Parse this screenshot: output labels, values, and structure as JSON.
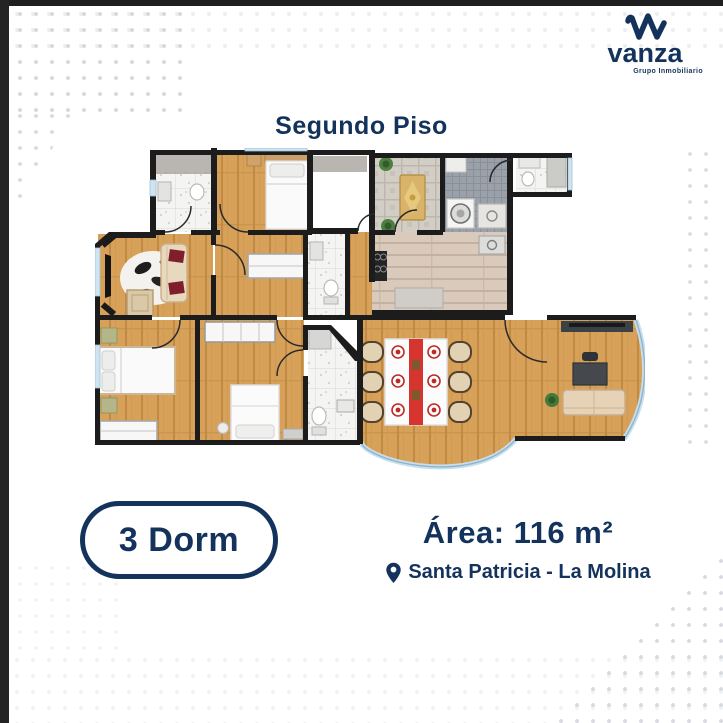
{
  "brand": {
    "name": "vanza",
    "tagline": "Grupo Inmobiliario"
  },
  "title": "Segundo Piso",
  "badge": {
    "label": "3 Dorm"
  },
  "details": {
    "area": "Área: 116 m²",
    "location": "Santa Patricia - La Molina"
  },
  "colors": {
    "navy": "#14335C",
    "dot_gray": "#D3D6DB",
    "wall_black": "#1C1C1C",
    "wood_floor": "#D7A159",
    "kitchen_floor": "#D9CABC",
    "terrace_stone": "#D2CDC5",
    "laundry_tile": "#9AA1A9",
    "bath_tile": "#F4F4F2",
    "glass_blue": "#BFDCEC",
    "runner_red": "#D6342E",
    "sofa_beige": "#E6D2B6"
  },
  "floor_plan": {
    "floor": "2",
    "bedrooms": 3,
    "rooms_depicted": [
      "bedroom-1",
      "bedroom-2",
      "bedroom-3",
      "bathroom-1",
      "bathroom-2",
      "powder-room",
      "kitchen",
      "laundry",
      "terrace",
      "living-room",
      "dining-living-area",
      "hallway"
    ]
  }
}
